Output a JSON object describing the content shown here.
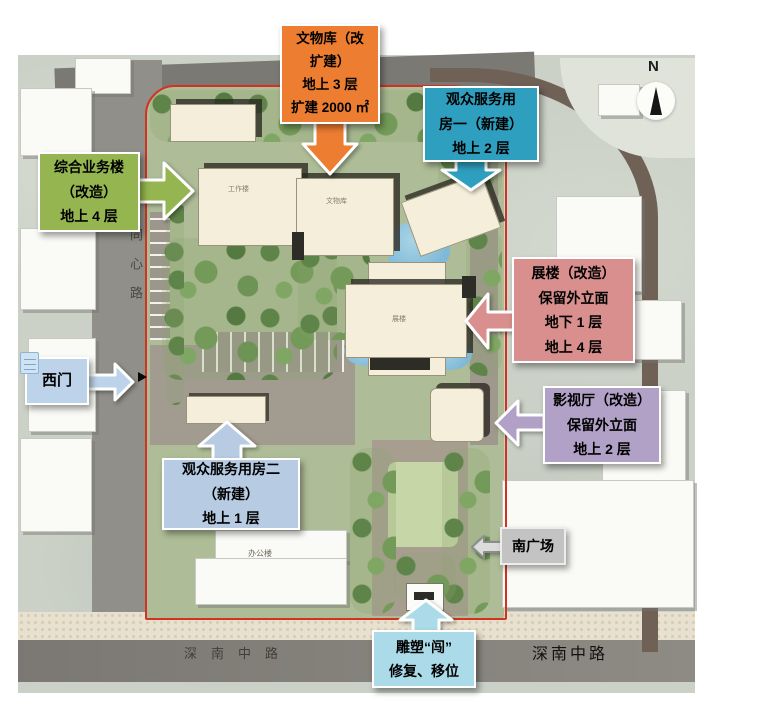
{
  "north_arrow": {
    "label": "N"
  },
  "roads": {
    "tongxin_lu": "同心路",
    "shennan_left": "深南中路",
    "shennan_right": "深南中路"
  },
  "map_labels": {
    "gongzuolou": "工作楼",
    "wenwuku": "文物库",
    "zhanlou": "展楼",
    "bangonglou": "办公楼"
  },
  "boundary_color": "#d23320",
  "callouts": [
    {
      "id": "wenwuku",
      "color": "#ED7D31",
      "arrow_fill": "#ED7D31",
      "arrow_stroke": "#ffffff",
      "direction": "down",
      "lines": [
        "文物库（改",
        "扩建）",
        "地上 3 层",
        "扩建 2000 ㎡"
      ]
    },
    {
      "id": "guanzhong-fuwu-1",
      "color": "#2F9FC0",
      "arrow_fill": "#2F9FC0",
      "arrow_stroke": "#ffffff",
      "direction": "down",
      "lines": [
        "观众服务用",
        "房一（新建）",
        "地上 2 层"
      ]
    },
    {
      "id": "zonghe-yewulou",
      "color": "#94B54F",
      "arrow_fill": "#94B54F",
      "arrow_stroke": "#ffffff",
      "direction": "right",
      "lines": [
        "综合业务楼",
        "（改造）",
        "地上 4 层"
      ]
    },
    {
      "id": "zhanlou",
      "color": "#D88F8D",
      "arrow_fill": "#D88F8D",
      "arrow_stroke": "#ffffff",
      "direction": "left",
      "lines": [
        "展楼（改造）",
        "保留外立面",
        "地下 1 层",
        "地上 4 层"
      ]
    },
    {
      "id": "yingshiting",
      "color": "#B2A1C7",
      "arrow_fill": "#B2A1C7",
      "arrow_stroke": "#ffffff",
      "direction": "left",
      "lines": [
        "影视厅（改造）",
        "保留外立面",
        "地上 2 层"
      ]
    },
    {
      "id": "ximen",
      "color": "#BDD3E9",
      "arrow_fill": "#BDD3E9",
      "arrow_stroke": "#ffffff",
      "direction": "right",
      "lines": [
        "西门"
      ]
    },
    {
      "id": "guanzhong-fuwu-2",
      "color": "#B7CCE3",
      "arrow_fill": "#B7CCE3",
      "arrow_stroke": "#ffffff",
      "direction": "up",
      "lines": [
        "观众服务用房二",
        "（新建）",
        "地上 1 层"
      ]
    },
    {
      "id": "nanguangchang",
      "color": "#C3C3C3",
      "arrow_fill": "#DCDCDC",
      "arrow_stroke": "#8c8c8c",
      "direction": "left",
      "lines": [
        "南广场"
      ]
    },
    {
      "id": "diaosu",
      "color": "#ABDBE8",
      "arrow_fill": "#ABDBE8",
      "arrow_stroke": "#ffffff",
      "direction": "up",
      "lines": [
        "雕塑“闯”",
        "修复、移位"
      ]
    }
  ]
}
